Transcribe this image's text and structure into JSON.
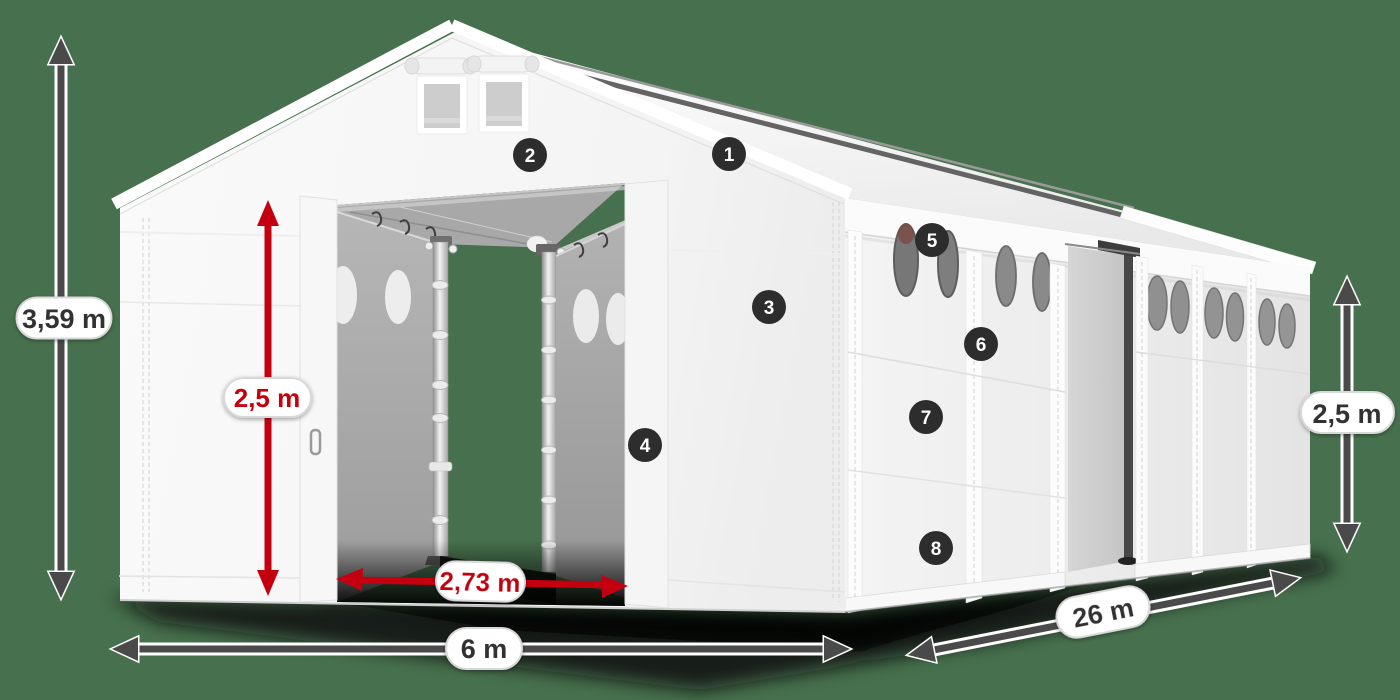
{
  "title": "Storage tent dimensions illustration",
  "scene": {
    "background_color": "#47714e",
    "tent_color": "#f6f6f6",
    "interior_color": "#a8a8a8",
    "dimension_arrow_color": "#4a4a4a",
    "highlight_arrow_color": "#c40010",
    "badge_color": "#2d2d2d",
    "badge_text_color": "#ffffff"
  },
  "labels": {
    "total_height": "3,59 m",
    "entrance_height": "2,5 m",
    "entrance_width": "2,73 m",
    "front_width": "6 m",
    "side_length": "26 m",
    "side_wall_height": "2,5 m"
  },
  "badges": [
    {
      "number": "1"
    },
    {
      "number": "2"
    },
    {
      "number": "3"
    },
    {
      "number": "4"
    },
    {
      "number": "5"
    },
    {
      "number": "6"
    },
    {
      "number": "7"
    },
    {
      "number": "8"
    }
  ]
}
